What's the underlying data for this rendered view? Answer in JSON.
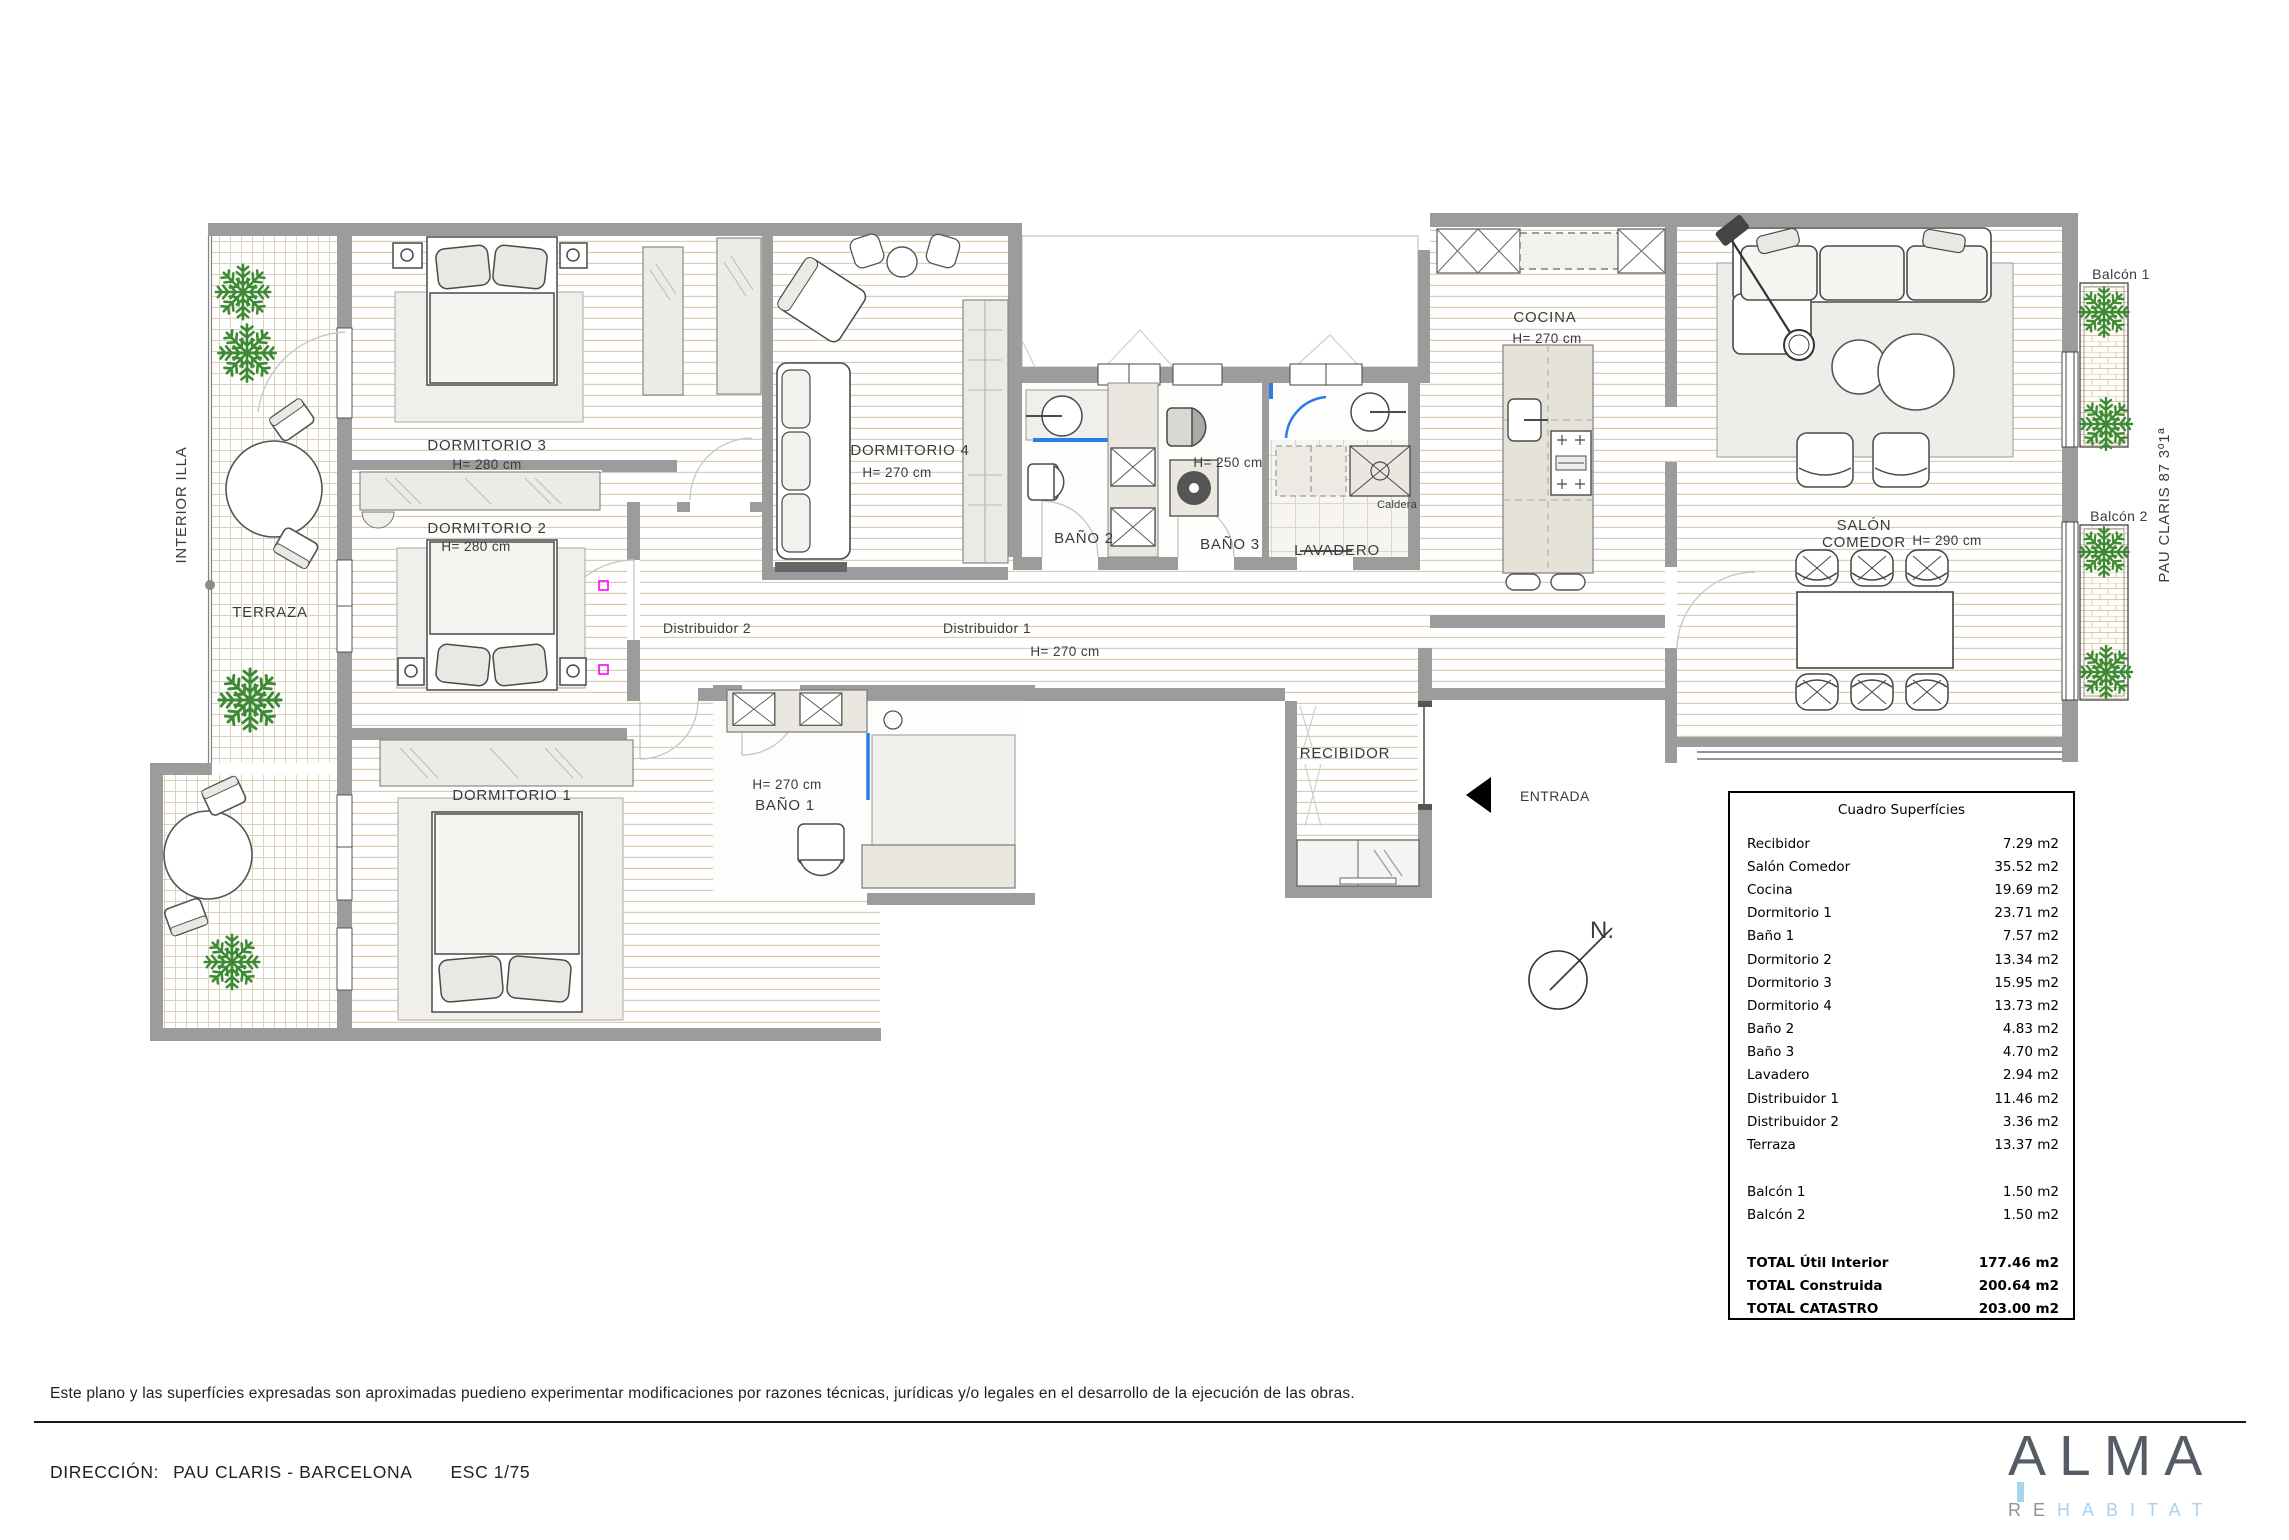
{
  "labels": {
    "interior_illa": "INTERIOR ILLA",
    "terraza": "TERRAZA",
    "dorm3": "DORMITORIO 3",
    "dorm3_h": "H= 280 cm",
    "dorm2": "DORMITORIO 2",
    "dorm2_h": "H= 280 cm",
    "dorm1": "DORMITORIO 1",
    "dorm4": "DORMITORIO 4",
    "dorm4_h": "H= 270 cm",
    "bano1": "BAÑO 1",
    "bano1_h": "H= 270 cm",
    "bano2": "BAÑO 2",
    "bano3": "BAÑO 3",
    "bano3_h": "H= 250 cm",
    "lavadero": "LAVADERO",
    "caldera": "Caldera",
    "cocina": "COCINA",
    "cocina_h": "H= 270 cm",
    "salon_l1": "SALÓN",
    "salon_l2": "COMEDOR",
    "salon_h": "H= 290 cm",
    "dist1": "Distribuidor 1",
    "dist1_h": "H= 270 cm",
    "dist2": "Distribuidor 2",
    "recibidor": "RECIBIDOR",
    "entrada": "ENTRADA",
    "north": "N.",
    "balcon1": "Balcón 1",
    "balcon2": "Balcón 2",
    "address_side": "PAU CLARIS 87 3º1ª"
  },
  "surface_table": {
    "title": "Cuadro Superfícies",
    "rows": [
      {
        "label": "Recibidor",
        "value": "7.29 m2"
      },
      {
        "label": "Salón Comedor",
        "value": "35.52 m2"
      },
      {
        "label": "Cocina",
        "value": "19.69 m2"
      },
      {
        "label": "Dormitorio 1",
        "value": "23.71 m2"
      },
      {
        "label": "Baño 1",
        "value": "7.57 m2"
      },
      {
        "label": "Dormitorio 2",
        "value": "13.34 m2"
      },
      {
        "label": "Dormitorio 3",
        "value": "15.95 m2"
      },
      {
        "label": "Dormitorio 4",
        "value": "13.73 m2"
      },
      {
        "label": "Baño 2",
        "value": "4.83 m2"
      },
      {
        "label": "Baño 3",
        "value": "4.70 m2"
      },
      {
        "label": "Lavadero",
        "value": "2.94 m2"
      },
      {
        "label": "Distribuidor 1",
        "value": "11.46 m2"
      },
      {
        "label": "Distribuidor 2",
        "value": "3.36 m2"
      },
      {
        "label": "Terraza",
        "value": "13.37 m2"
      },
      {
        "gap": true
      },
      {
        "label": "Balcón 1",
        "value": "1.50 m2"
      },
      {
        "label": "Balcón 2",
        "value": "1.50 m2"
      },
      {
        "gap": true
      },
      {
        "label": "TOTAL Útil Interior",
        "value": "177.46 m2",
        "bold": true
      },
      {
        "label": "TOTAL Construida",
        "value": "200.64 m2",
        "bold": true
      },
      {
        "label": "TOTAL CATASTRO",
        "value": "203.00 m2",
        "bold": true
      }
    ]
  },
  "footer": {
    "disclaimer": "Este plano y las superfícies expresadas son aproximadas puedieno experimentar modificaciones por razones técnicas, jurídicas y/o legales en el desarrollo de la ejecución de las obras.",
    "direccion_label": "DIRECCIÓN:",
    "direccion_value": "PAU CLARIS - BARCELONA",
    "escala": "ESC 1/75",
    "logo": {
      "name": "ALMA",
      "sub_gray": "RE",
      "sub_blue": "HABITAT"
    }
  },
  "colors": {
    "wall": "#9c9c9c",
    "floor_line": "#d8c9ac",
    "tree_green": "#3c8a33",
    "glass_blue": "#2a7de1",
    "accent_magenta": "#ff00ff",
    "logo_gray": "#565c65",
    "logo_blue": "#a7d3ee"
  }
}
